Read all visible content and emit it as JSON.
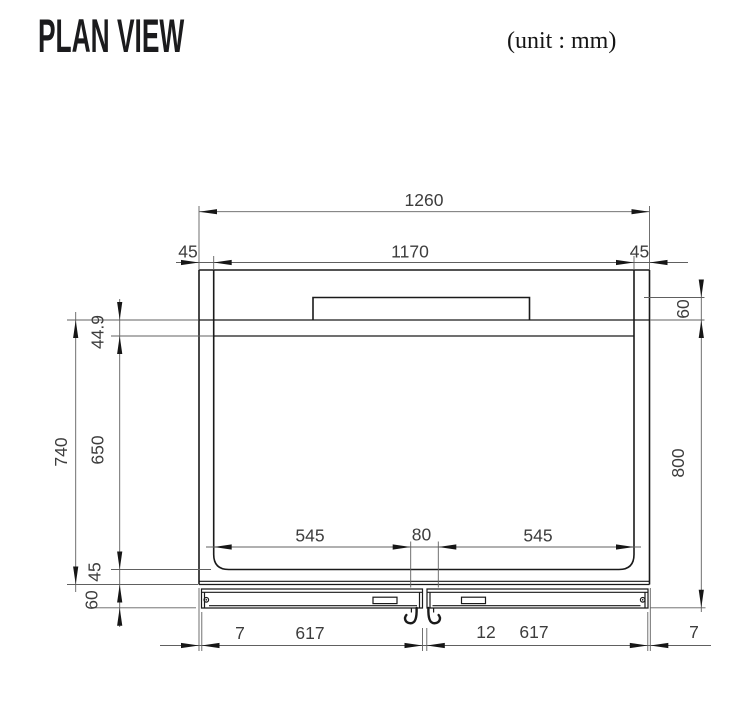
{
  "header": {
    "title": "PLAN VIEW",
    "unit_label": "(unit : mm)"
  },
  "dims": {
    "overall_width": "1260",
    "opening_width": "1170",
    "margin_left": "45",
    "margin_right": "45",
    "step_height": "60",
    "top_inset": "44.9",
    "depth_left": "740",
    "opening_depth": "650",
    "overall_depth": "800",
    "span_left": "545",
    "center_gap": "80",
    "span_right": "545",
    "bottom_inset": "45",
    "front_height": "60",
    "edge_left": "7",
    "panel_left": "617",
    "panel_gap": "12",
    "panel_right": "617",
    "edge_right": "7"
  }
}
